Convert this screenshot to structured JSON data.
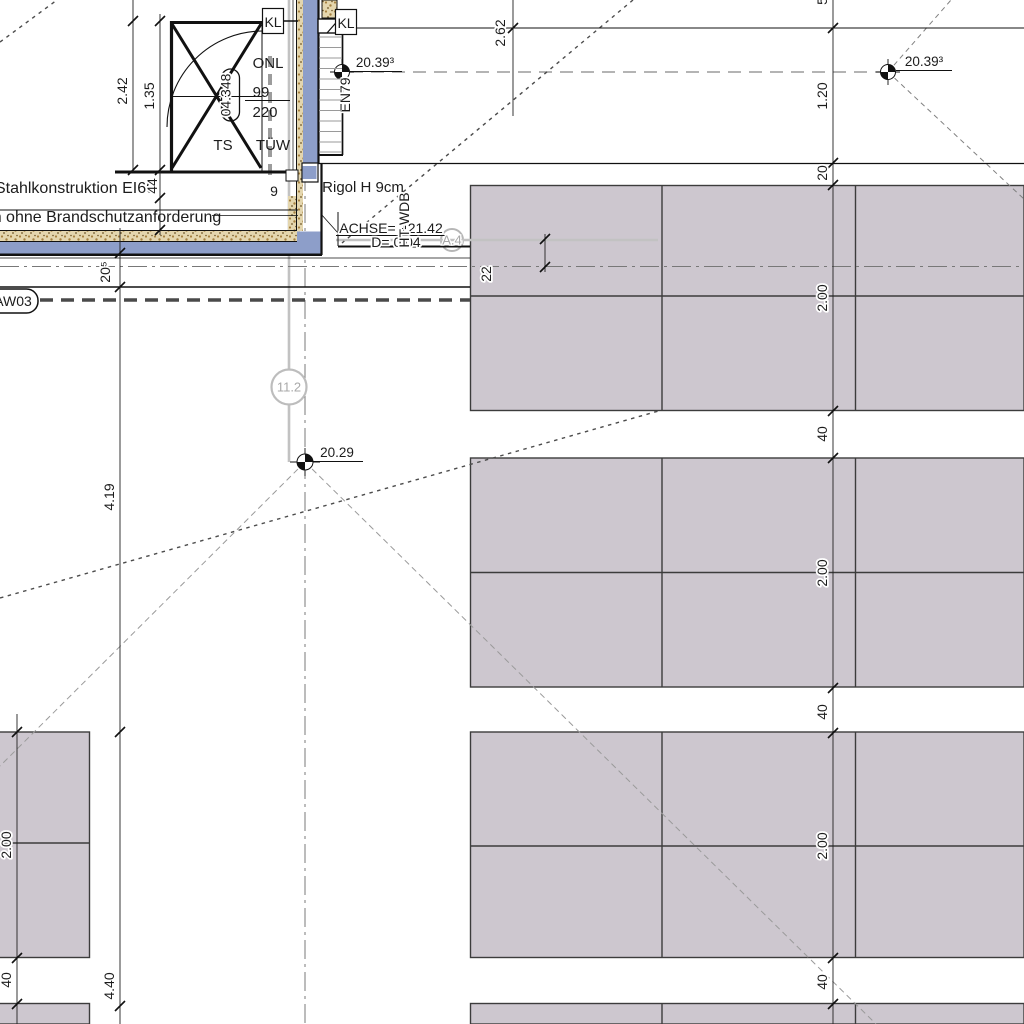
{
  "drawing_type": "architectural-plan-crop",
  "texts": {
    "stahlkonstruktion": "Stahlkonstruktion EI60",
    "brandschutz": "n ohne Brandschutzanforderung",
    "rigol": "Rigol H 9cm",
    "achse": "ACHSE= +21.42",
    "d_value": "D= 0.04",
    "ht_wdb": "HT-WDB",
    "axis_a4": "A.4",
    "axis_112": "11.2",
    "onl": "ONL",
    "room_no": "04.348",
    "door_w": "99",
    "door_h": "220",
    "ts": "TS",
    "tuw": "TÜW",
    "kl1": "KL",
    "kl2": "KL",
    "en79": "EN79",
    "aw03": "AW03",
    "lvl_stair": "20.39³",
    "lvl_grid": "20.39³",
    "lvl_mid": "20.29",
    "dim_242": "2.42",
    "dim_135": "1.35",
    "dim_44": "44",
    "dim_9": "9",
    "dim_205": "20⁵",
    "dim_419": "4.19",
    "dim_200_left": "2.00",
    "dim_40_left": "40",
    "dim_440": "4.40",
    "dim_262": "2.62",
    "dim_partial_top": "5",
    "dim_120": "1.20",
    "dim_20": "20",
    "dim_200_r1": "2.00",
    "dim_40_r1": "40",
    "dim_200_r2": "2.00",
    "dim_40_r2": "40",
    "dim_200_r3": "2.00",
    "dim_40_r3": "40",
    "dim_22": "22"
  },
  "colors": {
    "wall_blue": "#8d9ec9",
    "insulation_tan": "#e4d6ae",
    "insulation_dot": "#a5803f",
    "panel_fill": "#cdc7cf",
    "panel_stroke": "#3c3c3c",
    "axis_gray": "#c2c2c2",
    "centerline_gray": "#787878"
  }
}
